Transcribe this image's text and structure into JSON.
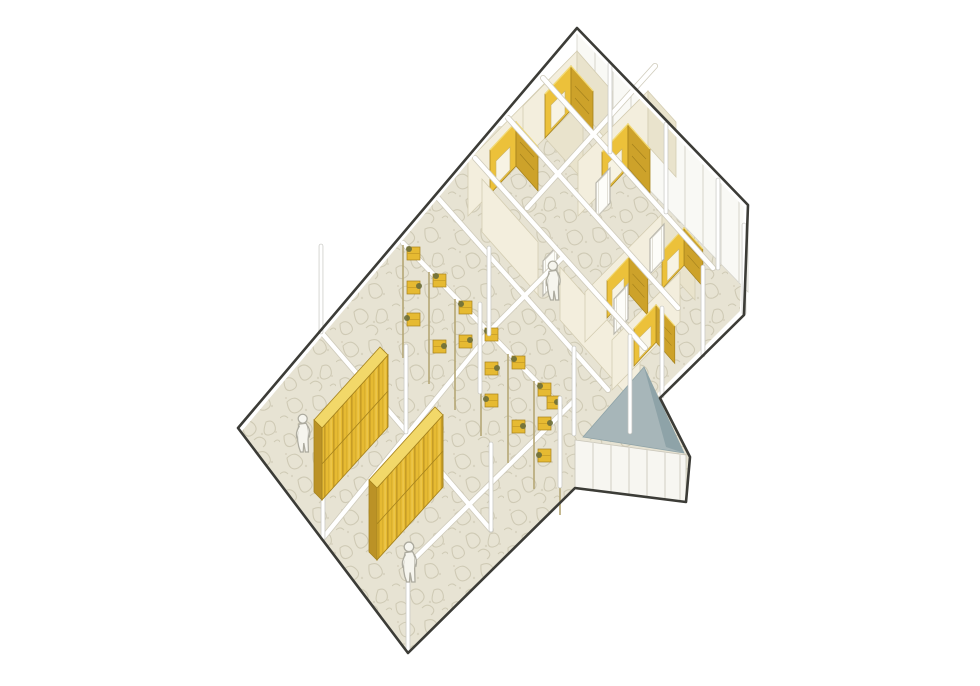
{
  "meta": {
    "kind": "architectural-axonometric-cutaway",
    "description": "Axonometric cutaway drawing of a two-block building: open hall with yellow slatted partitions, central green storage wall, cluster of small rooms with yellow wardrobe nooks, grey-roofed triangular porch annex",
    "figure_count": 3,
    "hall_partition_count": 2,
    "wardrobe_count": 6
  },
  "palette": {
    "paper": "#ffffff",
    "outline": "#3c3c37",
    "floor_base": "#e7e3d3",
    "floor_line": "#cbc6b0",
    "frame_white": "#ffffff",
    "frame_edge": "#c6c6c1",
    "wall_cream": "#f3eedd",
    "wall_shade": "#e9e3cc",
    "wall_edge": "#d4cdb2",
    "yellow": "#e6ba32",
    "yellow_dark": "#cda22a",
    "yellow_light": "#f2d869",
    "yellow_line": "#a5821d",
    "yellow_end": "#bb9226",
    "plant_olive": "#6b6e3a",
    "post_tan": "#b5a775",
    "roof_gray": "#a7b6b9",
    "roof_gray_dark": "#8ea3a8",
    "glass_white": "#f7f6f1",
    "mullion": "#d9d7cd",
    "figure_fill": "#f6f5ee",
    "figure_line": "#adab9f"
  }
}
